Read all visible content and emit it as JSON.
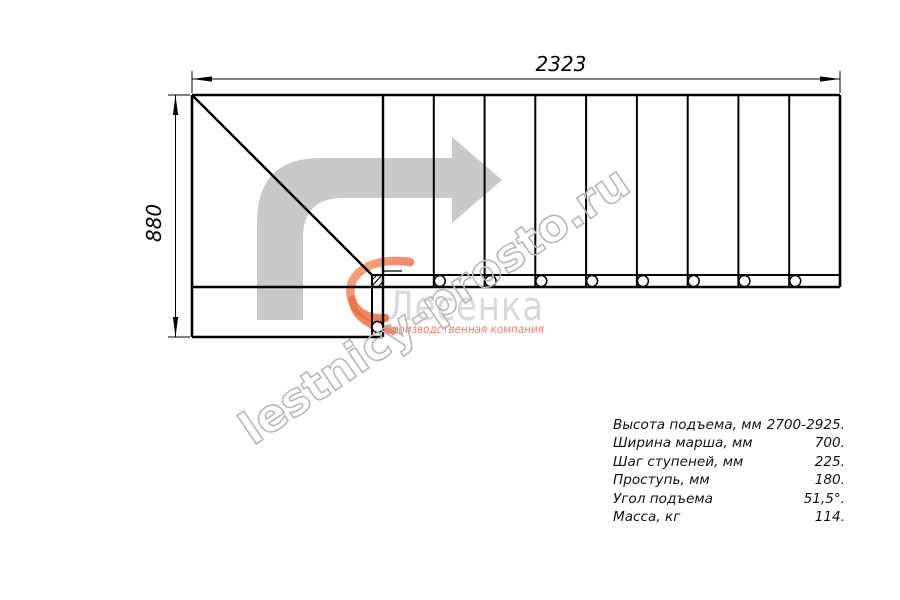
{
  "diagram": {
    "horizontal_dimension": "2323",
    "vertical_dimension": "880",
    "flight_step_lines": 8,
    "baluster_circles": 9
  },
  "watermark": {
    "text": "lestnicy-prosto.ru"
  },
  "logo": {
    "name": "Лесенка",
    "tagline": "Производственная компания"
  },
  "specs": {
    "rows": [
      {
        "label": "Высота подъема, мм",
        "value": "2700-2925."
      },
      {
        "label": "Ширина марша, мм",
        "value": "700."
      },
      {
        "label": "Шаг ступеней, мм",
        "value": "225."
      },
      {
        "label": "Проступь, мм",
        "value": "180."
      },
      {
        "label": "Угол подъема",
        "value": "51,5°."
      },
      {
        "label": "Масса, кг",
        "value": "114."
      }
    ]
  },
  "colors": {
    "line": "#000000",
    "direction_arrow": "#c9c9c9",
    "watermark_stroke": "#b8b8b8",
    "logo_name": "#d9d9d9",
    "logo_tagline": "#ee8070",
    "logo_mark_orange": "#ed6a3c",
    "background": "#ffffff"
  }
}
